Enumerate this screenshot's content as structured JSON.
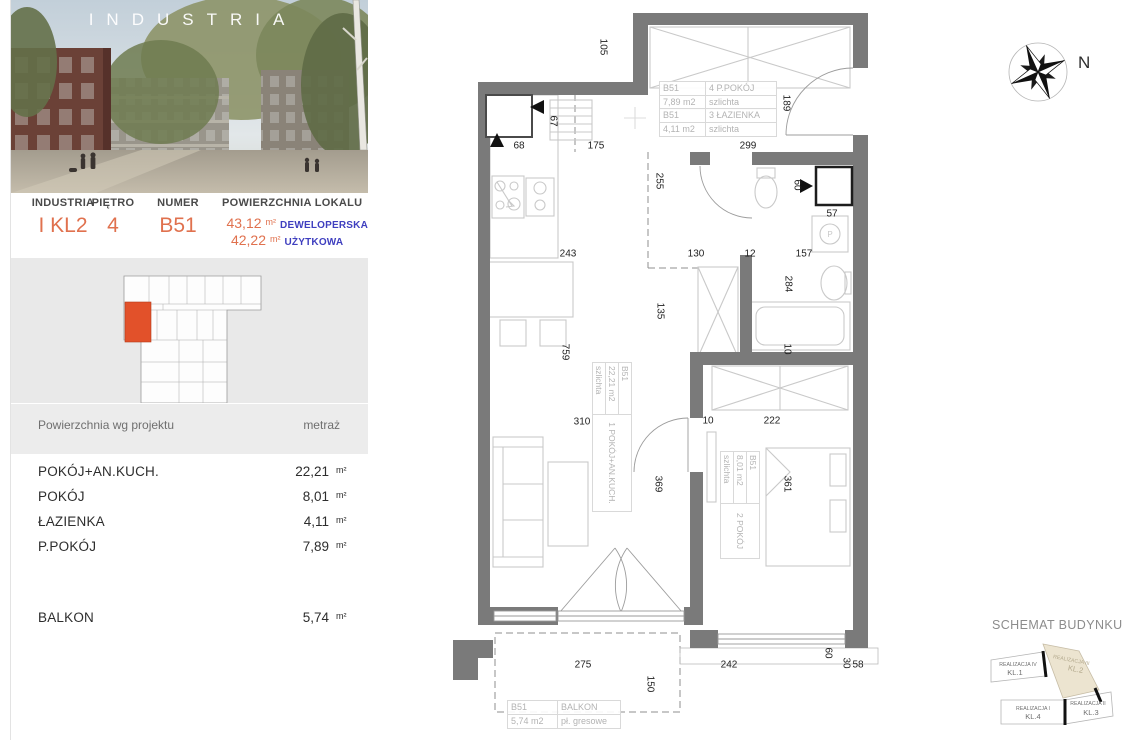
{
  "photo": {
    "brand": "INDUSTRIA"
  },
  "units": {
    "m2": "m²"
  },
  "unit_header": {
    "columns": [
      "INDUSTRIA",
      "PIĘTRO",
      "NUMER",
      "POWIERZCHNIA LOKALU"
    ],
    "building": "I KL2",
    "floor": "4",
    "number": "B51",
    "areas": [
      {
        "value": "43,12",
        "unit": "m²",
        "label": "DEWELOPERSKA"
      },
      {
        "value": "42,22",
        "unit": "m²",
        "label": "UŻYTKOWA"
      }
    ]
  },
  "rooms_table": {
    "header": {
      "name": "Powierzchnia wg projektu",
      "value": "metraż"
    },
    "rows": [
      {
        "name": "POKÓJ+AN.KUCH.",
        "value": "22,21",
        "unit": "m²"
      },
      {
        "name": "POKÓJ",
        "value": "8,01",
        "unit": "m²"
      },
      {
        "name": "ŁAZIENKA",
        "value": "4,11",
        "unit": "m²"
      },
      {
        "name": "P.POKÓJ",
        "value": "7,89",
        "unit": "m²"
      }
    ],
    "extra_rows": [
      {
        "name": "BALKON",
        "value": "5,74",
        "unit": "m²"
      }
    ]
  },
  "plan": {
    "tags": {
      "ppokoj": {
        "id": "B51",
        "area": "7,89 m2",
        "name": "4 P.POKÓJ",
        "floor": "szlichta"
      },
      "lazienka": {
        "id": "B51",
        "area": "4,11 m2",
        "name": "3 ŁAZIENKA",
        "floor": "szlichta"
      },
      "living": {
        "id": "B51",
        "area": "22,21 m2",
        "name": "1 POKÓJ+AN.KUCH.",
        "floor": "szlichta"
      },
      "bedroom": {
        "id": "B51",
        "area": "8,01 m2",
        "name": "2 POKÓJ",
        "floor": "szlichta"
      },
      "balkon": {
        "id": "B51",
        "area": "5,74 m2",
        "name": "BALKON",
        "floor": "pł. gresowe"
      }
    },
    "washer_symbol": "P",
    "dimensions": [
      {
        "t": "105",
        "x": 603,
        "y": 47,
        "r": 1
      },
      {
        "t": "67",
        "x": 553,
        "y": 121,
        "r": 1
      },
      {
        "t": "68",
        "x": 519,
        "y": 146,
        "r": 0
      },
      {
        "t": "175",
        "x": 596,
        "y": 146,
        "r": 0
      },
      {
        "t": "299",
        "x": 748,
        "y": 146,
        "r": 0
      },
      {
        "t": "189",
        "x": 786,
        "y": 103,
        "r": 1
      },
      {
        "t": "255",
        "x": 659,
        "y": 181,
        "r": 1
      },
      {
        "t": "60",
        "x": 797,
        "y": 185,
        "r": 1
      },
      {
        "t": "57",
        "x": 832,
        "y": 214,
        "r": 0
      },
      {
        "t": "243",
        "x": 568,
        "y": 254,
        "r": 0
      },
      {
        "t": "130",
        "x": 696,
        "y": 254,
        "r": 0
      },
      {
        "t": "12",
        "x": 750,
        "y": 254,
        "r": 0
      },
      {
        "t": "157",
        "x": 804,
        "y": 254,
        "r": 0
      },
      {
        "t": "284",
        "x": 788,
        "y": 284,
        "r": 1
      },
      {
        "t": "135",
        "x": 660,
        "y": 311,
        "r": 1
      },
      {
        "t": "759",
        "x": 565,
        "y": 352,
        "r": 1
      },
      {
        "t": "10",
        "x": 787,
        "y": 349,
        "r": 1
      },
      {
        "t": "310",
        "x": 582,
        "y": 422,
        "r": 0
      },
      {
        "t": "10",
        "x": 708,
        "y": 421,
        "r": 0
      },
      {
        "t": "222",
        "x": 772,
        "y": 421,
        "r": 0
      },
      {
        "t": "369",
        "x": 658,
        "y": 484,
        "r": 1
      },
      {
        "t": "361",
        "x": 787,
        "y": 484,
        "r": 1
      },
      {
        "t": "275",
        "x": 583,
        "y": 665,
        "r": 0
      },
      {
        "t": "242",
        "x": 729,
        "y": 665,
        "r": 0
      },
      {
        "t": "150",
        "x": 650,
        "y": 684,
        "r": 1
      },
      {
        "t": "60",
        "x": 828,
        "y": 653,
        "r": 1
      },
      {
        "t": "30",
        "x": 846,
        "y": 663,
        "r": 1
      },
      {
        "t": "58",
        "x": 858,
        "y": 665,
        "r": 0
      }
    ]
  },
  "compass": {
    "label": "N"
  },
  "schemat": {
    "title": "SCHEMAT BUDYNKU",
    "segments": [
      {
        "line1": "REALIZACJA IV",
        "line2": "KL.1",
        "highlight": false
      },
      {
        "line1": "REALIZACJA III",
        "line2": "KL.2",
        "highlight": true
      },
      {
        "line1": "REALIZACJA I",
        "line2": "KL.4",
        "highlight": false
      },
      {
        "line1": "REALIZACJA II",
        "line2": "KL.3",
        "highlight": false
      }
    ]
  },
  "colors": {
    "accent": "#e0714e",
    "label_blue": "#3f3fbf",
    "wall": "#7a7a7a",
    "unit_highlight": "#e2512a",
    "schemat_highlight": "#ece4d0"
  }
}
